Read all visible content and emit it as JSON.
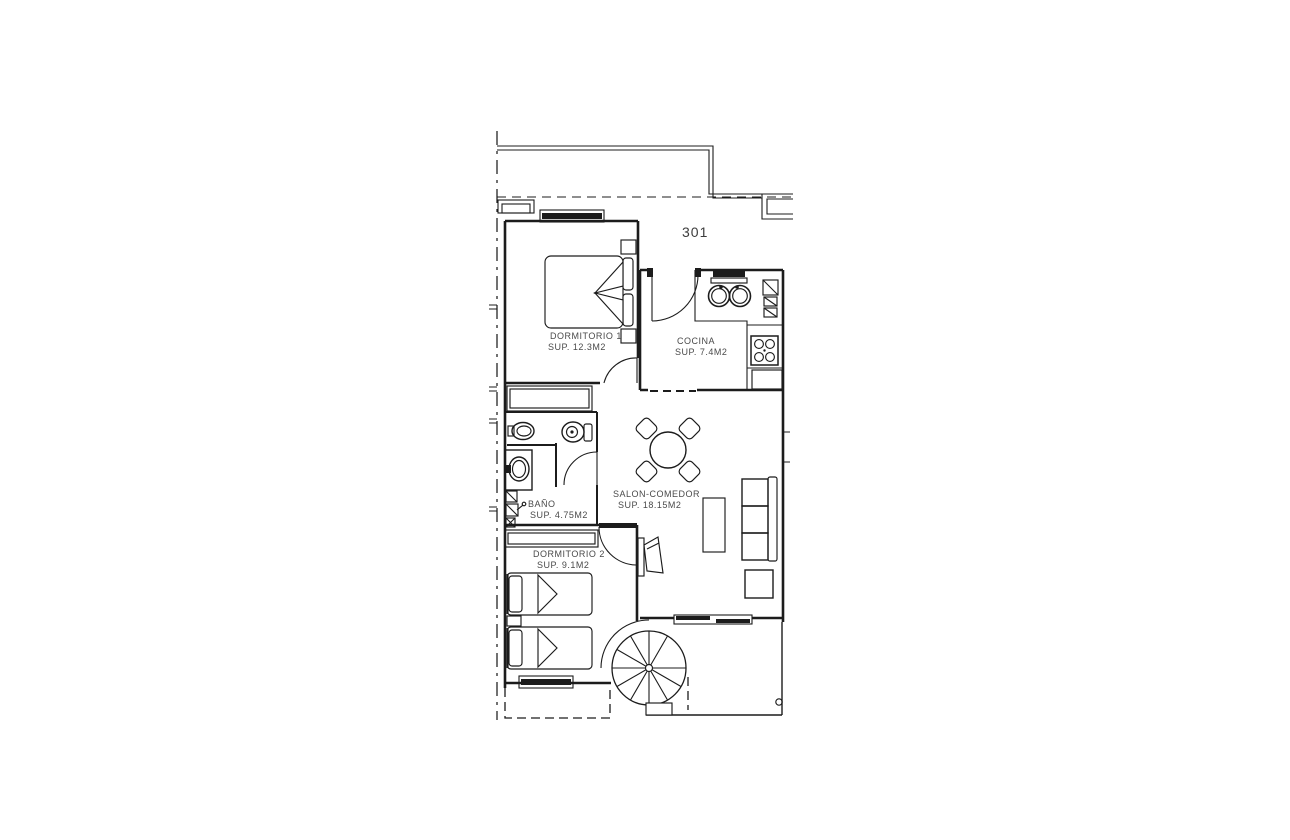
{
  "plan": {
    "unit_number": "301",
    "colors": {
      "line": "#1c1c1c",
      "text": "#4a4a4a",
      "background": "#ffffff"
    },
    "rooms": [
      {
        "id": "dormitorio1",
        "name": "DORMITORIO 1",
        "area": "SUP. 12.3M2"
      },
      {
        "id": "cocina",
        "name": "COCINA",
        "area": "SUP. 7.4M2"
      },
      {
        "id": "bano",
        "name": "BAÑO",
        "area": "SUP. 4.75M2"
      },
      {
        "id": "dormitorio2",
        "name": "DORMITORIO 2",
        "area": "SUP. 9.1M2"
      },
      {
        "id": "salon",
        "name": "SALON-COMEDOR",
        "area": "SUP. 18.15M2"
      }
    ]
  }
}
